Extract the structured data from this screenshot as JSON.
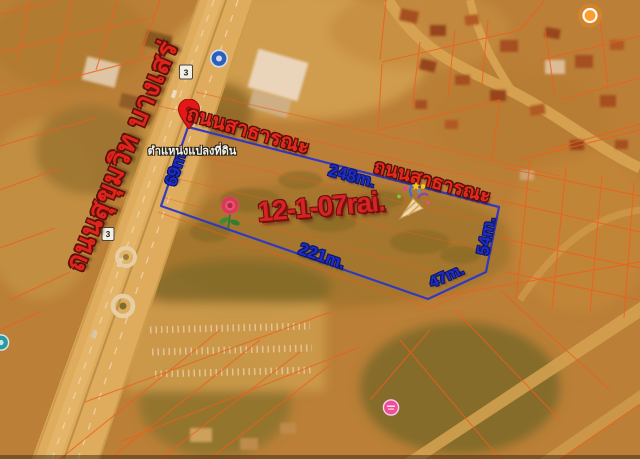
{
  "map": {
    "road": {
      "name_label": "ถนนสุขุมวิท บางเสร่",
      "route_number": "3"
    },
    "plot": {
      "area_label": "12-1-07rai.",
      "pin_caption": "ตำแหน่งแปลงที่ดิน",
      "public_road_label_top": "ถนนสาธารณะ",
      "public_road_label_right": "ถนนสาธารณะ",
      "dimensions": {
        "left": "69m.",
        "top": "248m.",
        "right": "54m.",
        "corner": "47m.",
        "bottom": "221m."
      }
    },
    "colors": {
      "plot_outline_blue": "#2b36c8",
      "dimension_text_blue": "#1e2ec4",
      "label_red": "#e0241a",
      "parcel_line_orange": "#f25a1c",
      "pin_red": "#e81717"
    },
    "icons": {
      "pin": "location-pin",
      "rose": "rose-flower",
      "party": "party-popper"
    }
  }
}
